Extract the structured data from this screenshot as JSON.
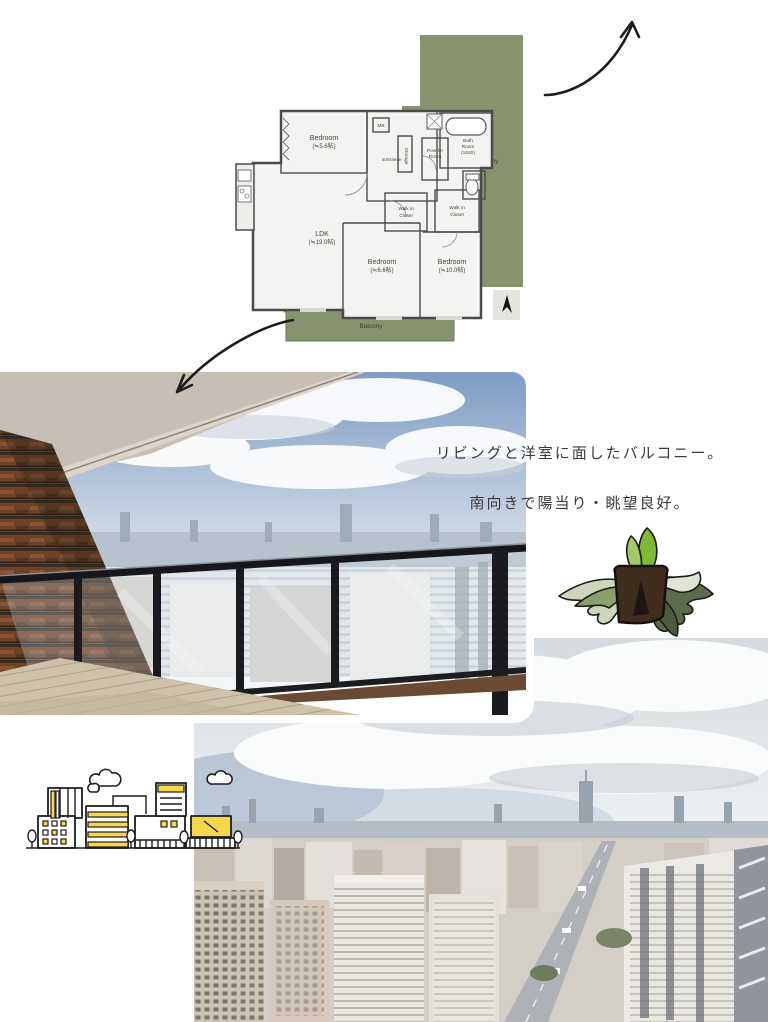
{
  "canvas": {
    "background": "#ffffff"
  },
  "floor_plan": {
    "colors": {
      "balcony_green": "#87926f",
      "wall": "#4b4b4b",
      "room_fill": "#f4f3f1"
    },
    "roof_balcony_label": "Roof Balcony",
    "balcony_label": "Balcony",
    "rooms": {
      "bedroom_a": {
        "name": "Bedroom",
        "area": "(≒5.6帖)"
      },
      "ldk": {
        "name": "LDK",
        "area": "(≒19.0帖)"
      },
      "bedroom_b": {
        "name": "Bedroom",
        "area": "(≒6.6帖)"
      },
      "bedroom_c": {
        "name": "Bedroom",
        "area": "(≒10.0帖)"
      },
      "bath": {
        "line1": "Bath",
        "line2": "Room",
        "area": "(1620)"
      },
      "entrance": {
        "name": "Entrance"
      },
      "powder": {
        "line1": "Powder",
        "line2": "Room"
      },
      "mb": {
        "name": "MB"
      },
      "storage": {
        "name": "Storage"
      },
      "wic_a": {
        "line1": "Walk in",
        "line2": "Closet"
      },
      "wic_b": {
        "line1": "Walk in",
        "line2": "Closet"
      }
    }
  },
  "caption": {
    "line1": "リビングと洋室に面したバルコニー。",
    "line2": "南向きで陽当り・眺望良好。"
  },
  "decorations": {
    "arrow_top": "curved-arrow-up-right",
    "arrow_left": "curved-arrow-down-left",
    "plant": "potted-staghorn-fern-illustration",
    "city_illustration": "line-art-city-buildings",
    "accent_yellow": "#f6d74b"
  }
}
